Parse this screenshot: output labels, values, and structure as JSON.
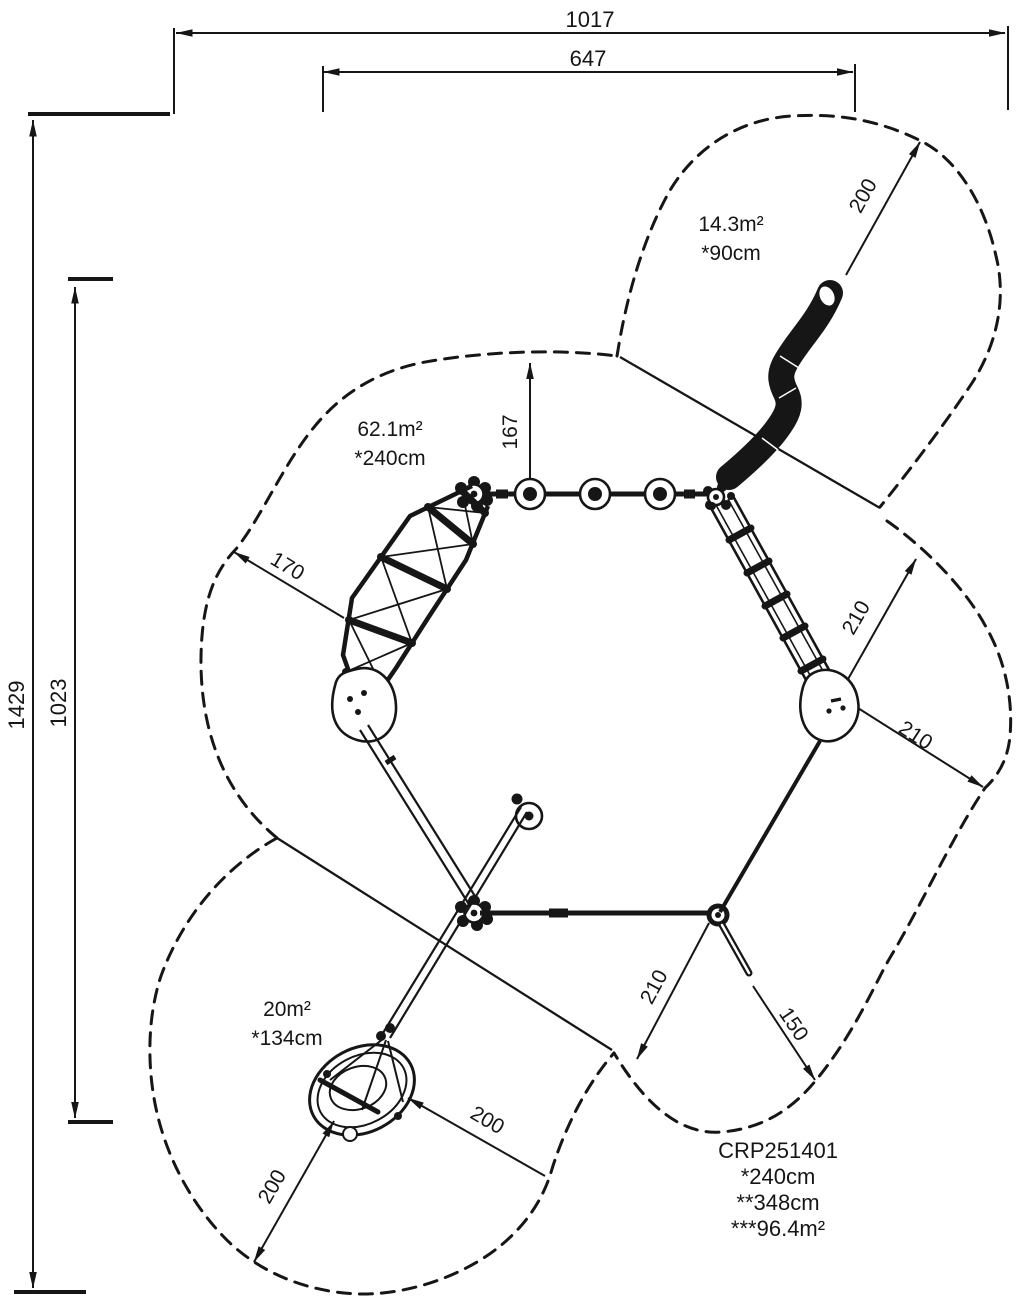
{
  "page": {
    "background": "#ffffff",
    "line_color": "#161616"
  },
  "title_block": {
    "product_code": "CRP251401",
    "fall_height": "*240cm",
    "total_height": "**348cm",
    "safety_area": "***96.4m²"
  },
  "zones": [
    {
      "area": "14.3m²",
      "fall_height": "*90cm"
    },
    {
      "area": "62.1m²",
      "fall_height": "*240cm"
    },
    {
      "area": "20m²",
      "fall_height": "*134cm"
    }
  ],
  "dimensions": {
    "overall_width": "1017",
    "inner_width": "647",
    "overall_depth": "1429",
    "inner_depth": "1023",
    "top_post_offset": "167",
    "net_zone": "170",
    "snake_zone": "200",
    "ladder_zone_upper": "210",
    "ladder_zone_lower": "210",
    "bottom_zone": "210",
    "pole_zone": "150",
    "swing_zone_right": "200",
    "swing_zone_left": "200"
  }
}
